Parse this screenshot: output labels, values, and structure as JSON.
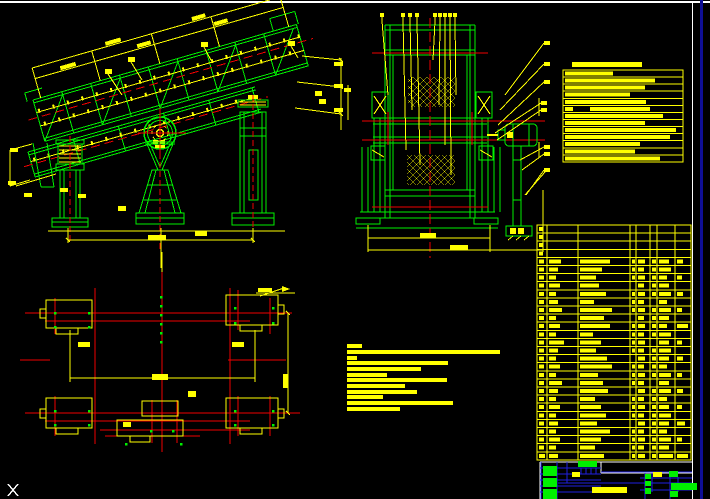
{
  "viewport": {
    "width": 710,
    "height": 499,
    "background": "#000000"
  },
  "colors": {
    "green": "#00f000",
    "yellow": "#ffff00",
    "red": "#f00000",
    "white": "#ffffff",
    "blue": "#2020df",
    "navy": "#0f0f96",
    "black": "#000000"
  },
  "frame": {
    "top_line_y": 2,
    "sheet_border_x": 692,
    "window_edge_x": 700
  },
  "views": {
    "side_view": "vibrating-screen-side-elevation",
    "front_view": "vibrating-screen-end-elevation",
    "plan_view": "foundation-plan"
  },
  "notes_top_right": {
    "title_bar": {
      "x": 572,
      "y": 62,
      "w": 70,
      "h": 5
    },
    "box": {
      "x": 563,
      "y": 70,
      "w": 120,
      "h": 92
    },
    "row_h": 7.07,
    "bar_x": 565,
    "bar_h": 4,
    "rows": [
      {
        "w": 48
      },
      {
        "w": 90
      },
      {
        "w": 80
      },
      {
        "w": 65
      },
      {
        "w": 81
      },
      {
        "w": 8,
        "x2": 590,
        "w2": 60
      },
      {
        "w": 98
      },
      {
        "w": 80
      },
      {
        "w": 111
      },
      {
        "w": 105
      },
      {
        "w": 75
      },
      {
        "w": 70
      },
      {
        "w": 95
      }
    ]
  },
  "notes_bottom": {
    "x": 347,
    "bar_h": 4,
    "rows": [
      {
        "y": 344,
        "w": 15
      },
      {
        "y": 350,
        "w": 153
      },
      {
        "y": 356,
        "w": 10
      },
      {
        "y": 361,
        "w": 101
      },
      {
        "y": 367,
        "w": 74
      },
      {
        "y": 373,
        "w": 40
      },
      {
        "y": 378,
        "w": 100
      },
      {
        "y": 384,
        "w": 58
      },
      {
        "y": 390,
        "w": 70
      },
      {
        "y": 395,
        "w": 36
      },
      {
        "y": 401,
        "w": 106
      },
      {
        "y": 407,
        "w": 53
      }
    ]
  },
  "bom_table": {
    "x": 537,
    "y": 225,
    "w": 154,
    "h": 235,
    "col_x": [
      537,
      547,
      578,
      630,
      636,
      650,
      657,
      675,
      691
    ],
    "row_h": 8.1,
    "row_count": 29,
    "rows": [
      [
        4,
        0,
        0,
        0,
        0,
        0,
        0,
        0
      ],
      [
        4,
        0,
        0,
        0,
        0,
        0,
        0,
        0
      ],
      [
        4,
        0,
        0,
        0,
        0,
        0,
        0,
        0
      ],
      [
        4,
        0,
        0,
        0,
        0,
        0,
        0,
        0
      ],
      [
        5,
        12,
        30,
        3,
        7,
        4,
        10,
        6
      ],
      [
        5,
        9,
        22,
        3,
        6,
        4,
        12,
        0
      ],
      [
        5,
        7,
        16,
        3,
        7,
        4,
        8,
        5
      ],
      [
        5,
        11,
        19,
        0,
        6,
        4,
        10,
        0
      ],
      [
        5,
        7,
        26,
        3,
        7,
        4,
        12,
        6
      ],
      [
        5,
        9,
        14,
        3,
        6,
        0,
        8,
        0
      ],
      [
        5,
        13,
        32,
        3,
        7,
        4,
        12,
        5
      ],
      [
        5,
        7,
        24,
        0,
        6,
        4,
        10,
        0
      ],
      [
        5,
        11,
        30,
        3,
        7,
        4,
        8,
        11
      ],
      [
        5,
        7,
        13,
        3,
        6,
        4,
        12,
        0
      ],
      [
        5,
        15,
        21,
        3,
        7,
        0,
        10,
        5
      ],
      [
        5,
        9,
        16,
        3,
        6,
        4,
        12,
        0
      ],
      [
        5,
        7,
        27,
        0,
        7,
        4,
        10,
        6
      ],
      [
        5,
        11,
        32,
        3,
        6,
        4,
        8,
        0
      ],
      [
        5,
        7,
        18,
        3,
        7,
        4,
        12,
        5
      ],
      [
        5,
        13,
        23,
        3,
        6,
        0,
        10,
        0
      ],
      [
        5,
        9,
        28,
        0,
        7,
        4,
        12,
        6
      ],
      [
        5,
        7,
        15,
        3,
        6,
        4,
        8,
        0
      ],
      [
        5,
        11,
        21,
        3,
        7,
        4,
        10,
        5
      ],
      [
        5,
        7,
        26,
        3,
        6,
        4,
        12,
        0
      ],
      [
        5,
        9,
        17,
        0,
        7,
        4,
        10,
        8
      ],
      [
        5,
        7,
        30,
        3,
        6,
        4,
        8,
        0
      ],
      [
        5,
        11,
        21,
        3,
        7,
        4,
        12,
        5
      ],
      [
        5,
        7,
        15,
        3,
        6,
        4,
        10,
        0
      ],
      [
        6,
        9,
        24,
        3,
        7,
        4,
        14,
        11
      ]
    ]
  },
  "title_block": {
    "white_lines": [
      [
        540,
        462,
        692,
        462
      ],
      [
        540,
        462,
        540,
        499
      ],
      [
        601,
        462,
        601,
        473
      ],
      [
        601,
        473,
        692,
        473
      ]
    ],
    "blue_h": [
      [
        540,
        468,
        601,
        468
      ],
      [
        540,
        474,
        601,
        474
      ],
      [
        540,
        480,
        601,
        480
      ],
      [
        540,
        486,
        601,
        486
      ],
      [
        540,
        492,
        601,
        492
      ],
      [
        601,
        472,
        692,
        472
      ],
      [
        640,
        478,
        692,
        478
      ],
      [
        640,
        490,
        692,
        490
      ],
      [
        558,
        483,
        692,
        483
      ]
    ],
    "blue_v": [
      [
        541,
        462,
        541,
        499
      ],
      [
        557,
        462,
        557,
        499
      ],
      [
        567,
        462,
        567,
        483
      ],
      [
        581,
        468,
        581,
        474
      ],
      [
        586,
        468,
        586,
        474
      ],
      [
        591,
        468,
        591,
        474
      ],
      [
        596,
        468,
        596,
        474
      ],
      [
        645,
        473,
        645,
        499
      ],
      [
        652,
        473,
        652,
        492
      ],
      [
        670,
        473,
        670,
        499
      ],
      [
        678,
        477,
        678,
        492
      ]
    ],
    "green_blocks": [
      [
        543,
        466,
        14,
        10
      ],
      [
        543,
        478,
        14,
        9
      ],
      [
        543,
        489,
        14,
        10
      ],
      [
        578,
        461,
        19,
        6
      ],
      [
        645,
        474,
        6,
        5
      ],
      [
        645,
        481,
        6,
        5
      ],
      [
        645,
        488,
        6,
        6
      ],
      [
        669,
        471,
        9,
        6
      ],
      [
        671,
        483,
        26,
        7
      ],
      [
        670,
        491,
        8,
        6
      ]
    ],
    "yellow_blocks": [
      [
        592,
        487,
        35,
        6
      ],
      [
        653,
        472,
        9,
        5
      ],
      [
        572,
        472,
        8,
        5
      ]
    ]
  },
  "callouts": {
    "front_top_y": 13,
    "front_top": [
      [
        380,
        388,
        95
      ],
      [
        401,
        406,
        150
      ],
      [
        408,
        412,
        110
      ],
      [
        415,
        420,
        165
      ],
      [
        433,
        433,
        60
      ],
      [
        438,
        439,
        105
      ],
      [
        443,
        445,
        145
      ],
      [
        448,
        451,
        175
      ],
      [
        453,
        456,
        95
      ]
    ],
    "balloons": [
      {
        "x": 544,
        "y": 41,
        "lx": 505,
        "ly": 95
      },
      {
        "x": 544,
        "y": 62,
        "lx": 500,
        "ly": 110
      },
      {
        "x": 544,
        "y": 80,
        "lx": 498,
        "ly": 125
      },
      {
        "x": 541,
        "y": 101,
        "lx": 495,
        "ly": 133
      },
      {
        "x": 541,
        "y": 108,
        "lx": 497,
        "ly": 140
      },
      {
        "x": 544,
        "y": 145,
        "lx": 520,
        "ly": 160
      },
      {
        "x": 544,
        "y": 152,
        "lx": 522,
        "ly": 170
      },
      {
        "x": 544,
        "y": 168,
        "lx": 526,
        "ly": 195
      }
    ]
  },
  "labels": {
    "side": [
      [
        105,
        69,
        7,
        5
      ],
      [
        128,
        57,
        7,
        5
      ],
      [
        201,
        42,
        7,
        5
      ],
      [
        288,
        41,
        7,
        5
      ],
      [
        315,
        91,
        7,
        5
      ],
      [
        319,
        99,
        7,
        5
      ],
      [
        10,
        148,
        8,
        4
      ],
      [
        8,
        181,
        8,
        4
      ],
      [
        24,
        193,
        8,
        4
      ],
      [
        60,
        188,
        8,
        4
      ],
      [
        78,
        194,
        8,
        4
      ],
      [
        118,
        206,
        8,
        5
      ],
      [
        148,
        235,
        18,
        5
      ],
      [
        334,
        62,
        9,
        4
      ],
      [
        334,
        84,
        9,
        4
      ],
      [
        334,
        108,
        9,
        4
      ],
      [
        344,
        88,
        7,
        4
      ],
      [
        195,
        231,
        12,
        5
      ]
    ],
    "front": [
      [
        420,
        233,
        16,
        5
      ],
      [
        450,
        245,
        18,
        5
      ]
    ],
    "plan": [
      [
        78,
        342,
        12,
        5
      ],
      [
        232,
        342,
        12,
        5
      ],
      [
        152,
        374,
        16,
        6
      ],
      [
        188,
        391,
        8,
        6
      ],
      [
        123,
        422,
        8,
        5
      ],
      [
        283,
        374,
        5,
        14
      ],
      [
        258,
        288,
        14,
        4
      ]
    ]
  },
  "plan_green_ticks": [
    [
      54,
      312
    ],
    [
      88,
      312
    ],
    [
      54,
      326
    ],
    [
      88,
      326
    ],
    [
      234,
      307
    ],
    [
      272,
      307
    ],
    [
      234,
      322
    ],
    [
      272,
      322
    ],
    [
      54,
      410
    ],
    [
      88,
      410
    ],
    [
      54,
      424
    ],
    [
      88,
      424
    ],
    [
      234,
      410
    ],
    [
      272,
      410
    ],
    [
      234,
      424
    ],
    [
      272,
      424
    ],
    [
      150,
      430
    ],
    [
      172,
      430
    ],
    [
      160,
      296
    ],
    [
      160,
      305
    ],
    [
      160,
      314
    ],
    [
      160,
      323
    ],
    [
      160,
      332
    ],
    [
      160,
      341
    ],
    [
      125,
      443
    ],
    [
      180,
      443
    ]
  ],
  "ucs_marker": {
    "glyph": "X",
    "x": 8,
    "y": 484,
    "w": 10,
    "h": 12
  }
}
